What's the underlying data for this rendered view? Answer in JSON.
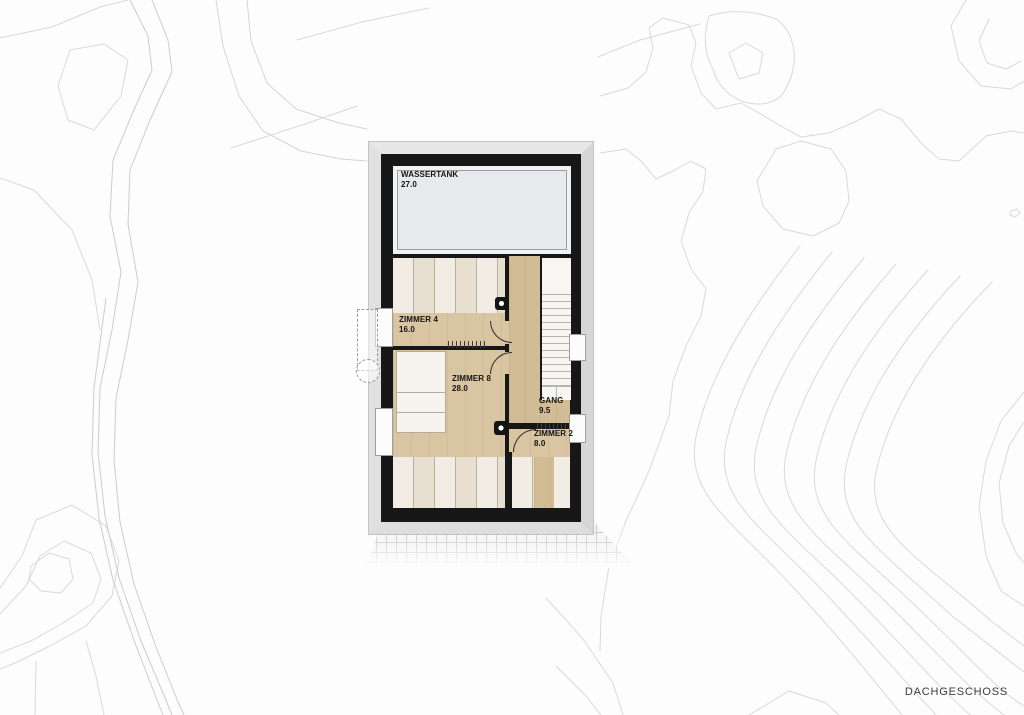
{
  "title": "DACHGESCHOSS",
  "rooms": {
    "wassertank": {
      "name": "WASSERTANK",
      "area": "27.0"
    },
    "zimmer4": {
      "name": "ZIMMER 4",
      "area": "16.0"
    },
    "zimmer8": {
      "name": "ZIMMER 8",
      "area": "28.0"
    },
    "gang": {
      "name": "GANG",
      "area": "9.5"
    },
    "zimmer2": {
      "name": "ZIMMER 2",
      "area": "8.0"
    }
  },
  "colors": {
    "wall": "#171717",
    "wood_floor": "#d9c5a2",
    "corridor_wood": "#d2bc95",
    "tank_room_fill": "#e8e9eb",
    "roof_edge": "#dedede",
    "contour_line": "#d9d9d9",
    "stair_fill": "#f7f6f3"
  }
}
